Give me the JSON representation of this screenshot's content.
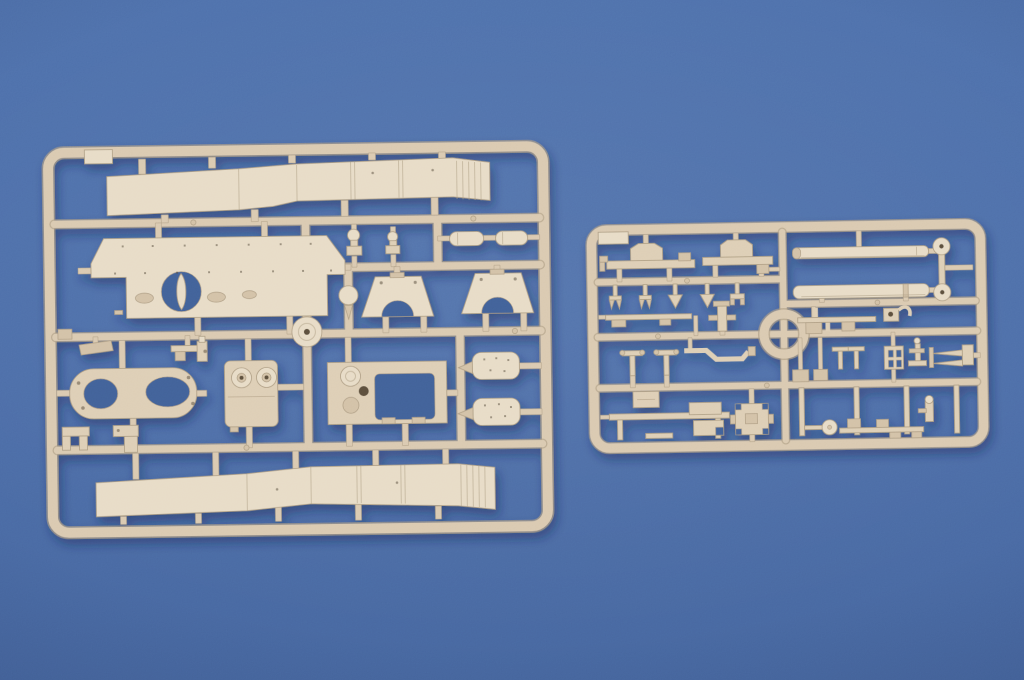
{
  "meta": {
    "type": "photograph",
    "subject": "Two tan injection-molded plastic model-kit sprues photographed on a blue background"
  },
  "colors": {
    "bg": "#4a6aa5",
    "bg_top": "#4d6ea9",
    "bg_bottom": "#45649c",
    "plastic": "#ddcdb3",
    "plastic_light": "#e7dbc5",
    "plastic_mid": "#d2c0a4",
    "plastic_rail": "#d9c8ae",
    "plastic_edge": "#ab9a7e",
    "plastic_deep": "#5a4d3b",
    "hole": "#405e95",
    "shadow": "#16254a"
  },
  "sprues": {
    "left": {
      "name": "large-parts-sprue",
      "parts": [
        "upper track fender",
        "hull roof plate with lens hole",
        "pair of dome ventilators",
        "pair of fuel-tank capsules",
        "pair of arch brackets",
        "road wheel",
        "oval intake frame",
        "twin-periscope housing",
        "engine hatch panel with opening",
        "pair of oval hatch covers",
        "small clips and brackets",
        "lower track fender"
      ]
    },
    "right": {
      "name": "small-parts-sprue",
      "parts": [
        "axle beams with brackets",
        "row of claw hooks",
        "two gun barrels",
        "disc wheels",
        "thin rods and cranks",
        "vented grid plate",
        "tow bars",
        "suspension posts",
        "assorted fittings",
        "central ring"
      ]
    }
  }
}
